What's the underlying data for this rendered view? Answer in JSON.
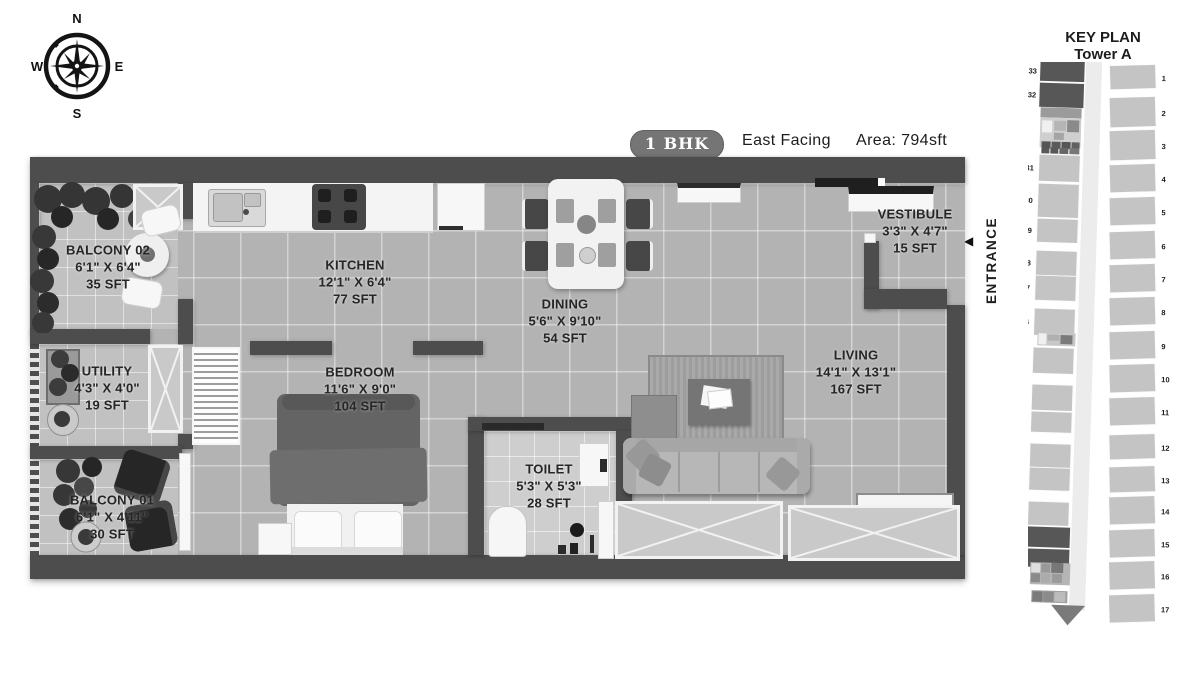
{
  "compass": {
    "north": "N",
    "east": "E",
    "south": "S",
    "west": "W"
  },
  "header": {
    "badge": "1 BHK",
    "facing": "East Facing",
    "area": "Area: 794sft"
  },
  "entrance": {
    "label": "ENTRANCE",
    "arrow": "◀"
  },
  "rooms": [
    {
      "id": "balcony-02",
      "name": "BALCONY 02",
      "dims": "6'1\" X 6'4\"",
      "area": "35 SFT"
    },
    {
      "id": "kitchen",
      "name": "KITCHEN",
      "dims": "12'1\" X 6'4\"",
      "area": "77 SFT"
    },
    {
      "id": "dining",
      "name": "DINING",
      "dims": "5'6\" X 9'10\"",
      "area": "54 SFT"
    },
    {
      "id": "vestibule",
      "name": "VESTIBULE",
      "dims": "3'3\" X 4'7\"",
      "area": "15 SFT"
    },
    {
      "id": "utility",
      "name": "UTILITY",
      "dims": "4'3\" X 4'0\"",
      "area": "19 SFT"
    },
    {
      "id": "bedroom",
      "name": "BEDROOM",
      "dims": "11'6\" X 9'0\"",
      "area": "104 SFT"
    },
    {
      "id": "toilet",
      "name": "TOILET",
      "dims": "5'3\" X 5'3\"",
      "area": "28 SFT"
    },
    {
      "id": "living",
      "name": "LIVING",
      "dims": "14'1\" X  13'1\"",
      "area": "167 SFT"
    },
    {
      "id": "balcony-01",
      "name": "BALCONY 01",
      "dims": "6'1\" X 4'11\"",
      "area": "30 SFT"
    }
  ],
  "key_plan": {
    "title": "KEY PLAN",
    "subtitle": "Tower A",
    "unit_color": "#c4c4c4",
    "highlight_color": "#575757",
    "left_units": [
      {
        "n": "33",
        "dark": true
      },
      {
        "n": "32",
        "dark": true
      },
      {
        "n": "31"
      },
      {
        "n": "30"
      },
      {
        "n": "29"
      },
      {
        "n": "28"
      },
      {
        "n": "27"
      },
      {
        "n": "26"
      },
      {
        "n": "25"
      },
      {
        "n": "24"
      },
      {
        "n": "23"
      },
      {
        "n": "22"
      },
      {
        "n": "21"
      },
      {
        "n": "20"
      },
      {
        "n": "19",
        "dark": true
      },
      {
        "n": "18",
        "dark": true
      }
    ],
    "right_units": [
      "1",
      "2",
      "3",
      "4",
      "5",
      "6",
      "7",
      "8",
      "9",
      "10",
      "11",
      "12",
      "13",
      "14",
      "15",
      "16",
      "17"
    ]
  },
  "colors": {
    "wall": "#4d4d4d",
    "floor": "#b3b3b3",
    "badge": "#757575"
  }
}
